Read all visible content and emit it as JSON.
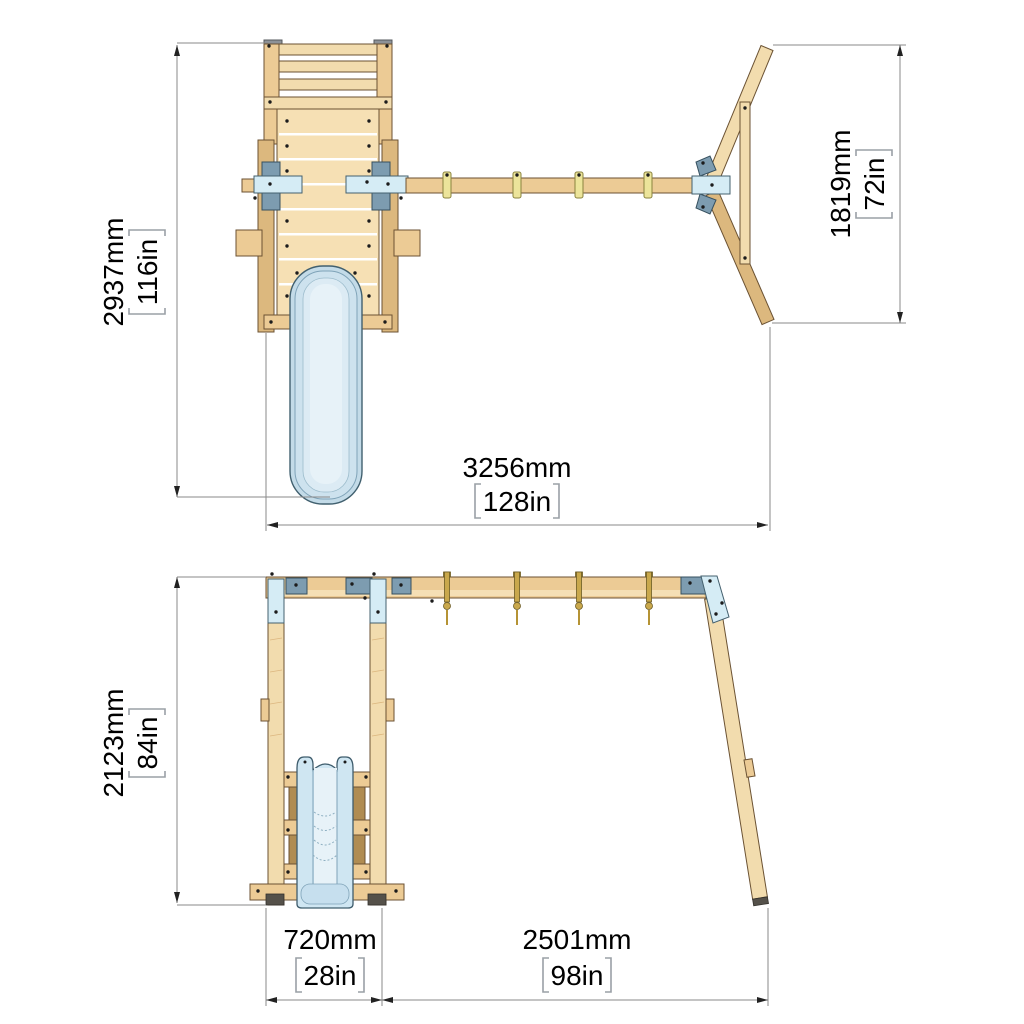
{
  "drawing": {
    "description": "Two-view technical dimension drawing of a wooden swing set with platform tower, slide and monkey-bar beam",
    "top_view": {
      "overall_height": {
        "metric": "2937mm",
        "imperial": "116in"
      },
      "aframe_depth": {
        "metric": "1819mm",
        "imperial": "72in"
      },
      "overall_width": {
        "metric": "3256mm",
        "imperial": "128in"
      }
    },
    "front_view": {
      "overall_height": {
        "metric": "2123mm",
        "imperial": "84in"
      },
      "platform_bay_width": {
        "metric": "720mm",
        "imperial": "28in"
      },
      "swing_bay_width": {
        "metric": "2501mm",
        "imperial": "98in"
      }
    },
    "colors": {
      "wood_light": "#f2dcae",
      "wood_mid": "#eccb95",
      "wood_dark": "#dcb87e",
      "steel_light_blue": "#d5ecf5",
      "steel_blue_grey": "#7d9cb0",
      "slide_blue": "#cfe5f1",
      "hook_gold": "#c9a84c",
      "dimension_line": "#8a8a8a",
      "text": "#000000",
      "background": "#ffffff"
    }
  }
}
